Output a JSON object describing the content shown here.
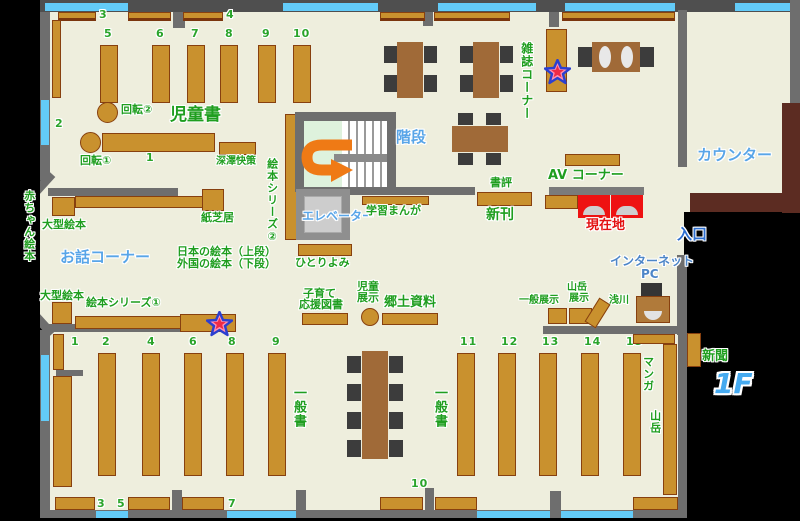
{
  "floor": {
    "badge": "1F"
  },
  "areas": {
    "jidousho": "児童書",
    "ohanashi": "お話コーナー",
    "zasshi": "雑誌コーナー",
    "kaidan": "階段",
    "elevator": "エレベーター",
    "counter": "カウンター",
    "av_corner": "AV コーナー",
    "iriguchi": "入口",
    "internet": "インターネット",
    "pc": "PC",
    "genzaichi": "現在地",
    "shinkan": "新刊",
    "shohyo": "書評",
    "shinbun": "新聞",
    "ippansho": "一般書"
  },
  "labels": {
    "kaiten1": "回転①",
    "kaiten2": "回転②",
    "fukazawa": "深澤快策",
    "ehon_series2": "絵本シリーズ②",
    "ehon_series1": "絵本シリーズ①",
    "kamishibai": "紙芝居",
    "ogata_ehon": "大型絵本",
    "akachan_ehon": "赤ちゃん絵本",
    "nihon_ehon": "日本の絵本（上段）",
    "gaikoku_ehon": "外国の絵本（下段）",
    "hitoriyomi": "ひとりよみ",
    "gakushu_manga": "学習まんが",
    "kosodate1": "子育て",
    "kosodate2": "応援図書",
    "jido_tenji1": "児童",
    "jido_tenji2": "展示",
    "kyodo_shiryo": "郷土資料",
    "ippan_tenji": "一般展示",
    "sangaku_tenji1": "山岳",
    "sangaku_tenji2": "展示",
    "asakawa": "浅川",
    "manga": "マンガ",
    "sangaku": "山岳"
  },
  "nums": {
    "top": [
      "3",
      "4"
    ],
    "child": [
      "5",
      "6",
      "7",
      "8",
      "9",
      "10"
    ],
    "side": [
      "2",
      "1"
    ],
    "genL": [
      "1",
      "2",
      "4",
      "6",
      "8",
      "9"
    ],
    "genR": [
      "11",
      "12",
      "13",
      "14",
      "15"
    ],
    "bottom": [
      "3",
      "5",
      "7",
      "10"
    ]
  },
  "colors": {
    "floor": "#eeeedd",
    "shelf": "#c9912e",
    "wall": "#6e6e6e",
    "window": "#63cbf8",
    "label_green": "#1f9e1f",
    "label_blue": "#58a5e8",
    "current_red": "#e31111",
    "arrow_orange": "#ef7a15",
    "counter_brown": "#5c2c22"
  }
}
